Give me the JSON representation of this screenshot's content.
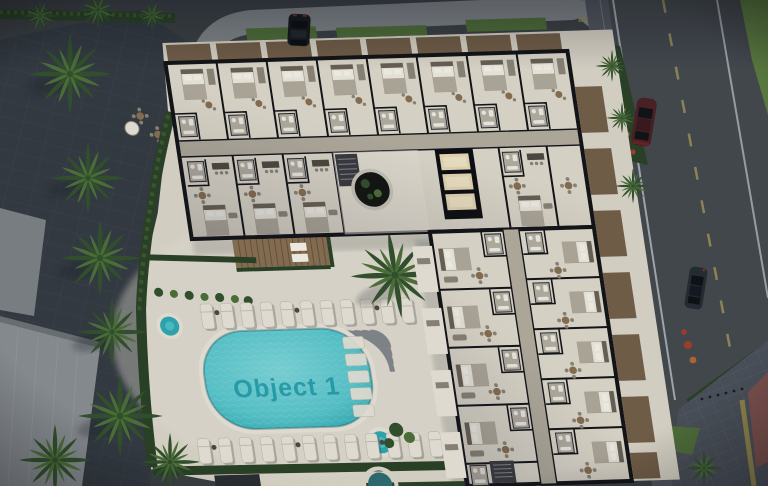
{
  "watermark": {
    "label": "Object 1"
  },
  "colors": {
    "asphalt": "#3d4147",
    "road": "#45494f",
    "road_line": "#c6cbd1",
    "lane_yellow": "#b3a45c",
    "sidewalk": "#535860",
    "walkway": "#343a42",
    "pavement": "#83878c",
    "plaza": "#4b515a",
    "plaza_pink": "#7e524f",
    "tactile_yellow": "#a08f4e",
    "roof_a": "#7e8287",
    "roof_b": "#8b8f94",
    "grass": "#516f3a",
    "grass_bright": "#5d7c41",
    "hedge": "#2b4226",
    "palm_dark": "#33522d",
    "palm_light": "#4d7139",
    "deck": "#dcd6ca",
    "deck_bright": "#eae4d8",
    "pool_rim": "#e9e4d9",
    "pool_water": "#58c7cd",
    "pool_deep": "#2fa9b2",
    "pool_text": "#1795a5",
    "spa_water": "#2e6c73",
    "wall": "#131318",
    "floor": "#e0dacd",
    "corridor": "#b4ad9f",
    "wood": "#8a6f52",
    "balcony_wood": "#745f49",
    "counter": "#4e4942",
    "furniture": "#8d8579",
    "bed": "#efeae0",
    "blanket": "#b2aa9c",
    "headboard": "#6a6156",
    "pillow": "#f7f3ea",
    "bath": "#b5afa3",
    "fixture": "#f1ede4",
    "lift_glow": "#e8dab6",
    "car_dark": "#17191d",
    "car_maroon": "#4b2026",
    "car_blue": "#262c34",
    "flower_red": "#a43e2f",
    "flower_orange": "#b06a35",
    "shadow": "#1b2028"
  },
  "scene": {
    "elements": [
      "apartment-building-floor-plan",
      "swimming-pool",
      "sun-loungers",
      "jacuzzi",
      "spa-pools",
      "palm-trees",
      "pergola-terrace",
      "elevator-core",
      "atrium-lightwell",
      "roads",
      "sidewalks",
      "parked-cars",
      "hedges",
      "flower-beds",
      "plaza"
    ]
  }
}
